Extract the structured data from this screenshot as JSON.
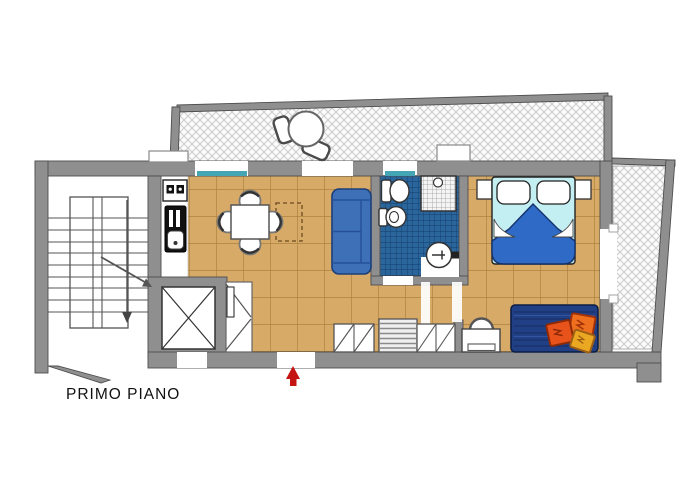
{
  "plan": {
    "title": "PRIMO PIANO"
  },
  "colors": {
    "wall": "#8f8f8f",
    "wall_line": "#4e4e4e",
    "floor": "#d8aa68",
    "floor_line": "#a0752f",
    "bath_tile": "#2a659c",
    "bath_line": "#143e6b",
    "sill": "#44a5b5",
    "sofa": "#3e70b8",
    "sofa_line": "#1c3e78",
    "bed_sheet": "#c3eef2",
    "bed_blanket": "#2e6ac6",
    "rug": "#213f84",
    "cushion_orange": "#ee6f1e",
    "cushion_red": "#e8531c",
    "cushion_yellow": "#eaa722",
    "accent_red": "#c41414"
  }
}
